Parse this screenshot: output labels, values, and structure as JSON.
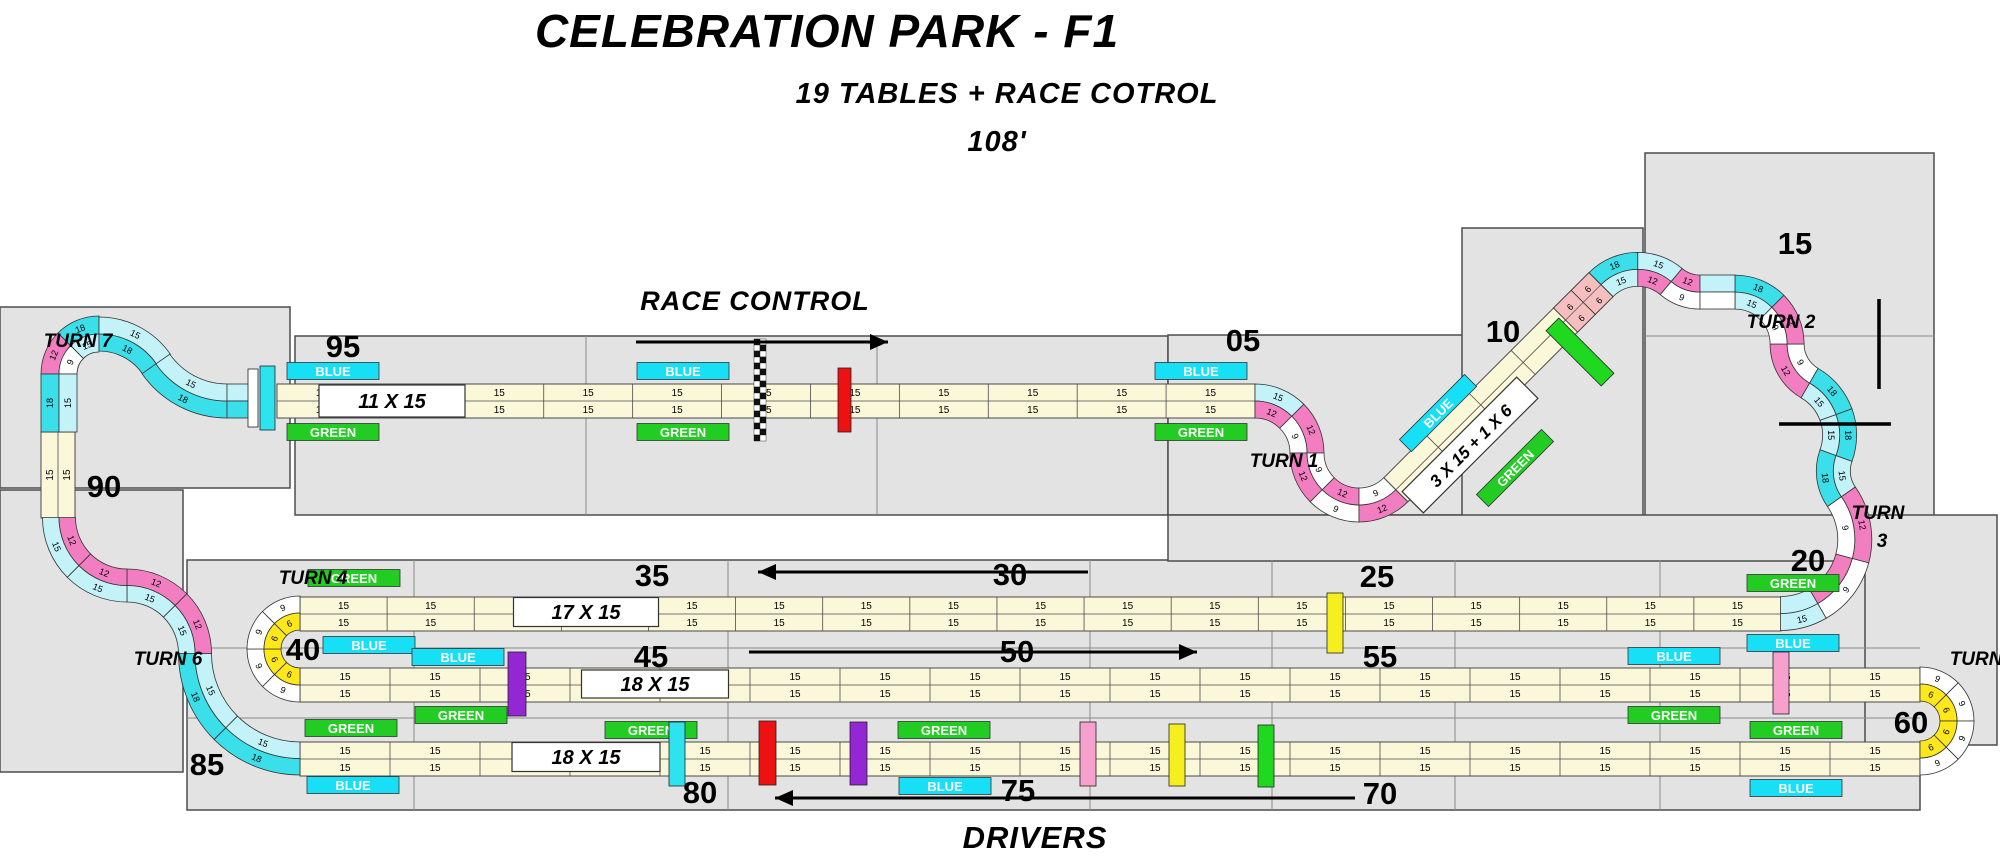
{
  "header": {
    "title": "CELEBRATION PARK - F1",
    "subtitle": "19 TABLES + RACE COTROL",
    "track_length": "108'",
    "race_control_label": "RACE CONTROL",
    "drivers_label": "DRIVERS"
  },
  "palette": {
    "table": "#E3E3E3",
    "table_stroke": "#4D4D4D",
    "straight": "#FBF8D9",
    "straight_stroke": "#4A4A4A",
    "C": "#3BDFE9",
    "P": "#C3F2F9",
    "K": "#F27EC1",
    "W": "#FFFFFF",
    "Y": "#FFE81A",
    "S": "#F5BFBF",
    "chip_blue": "#17DFF5",
    "chip_green": "#22CC22",
    "bar_red": "#EE1111",
    "bar_purple": "#9327D4",
    "bar_pink": "#F6A0CE",
    "bar_yellow": "#F6EF1F",
    "bar_green": "#20D820",
    "bar_cyan": "#2EE3EE",
    "bar_white": "#FFFFFF"
  },
  "turn_labels": [
    [
      "TURN 7",
      38,
      341
    ],
    [
      "TURN 2",
      1741,
      322
    ],
    [
      "TURN 1",
      1244,
      461
    ],
    [
      "TURN",
      1838,
      513
    ],
    [
      "3",
      1842,
      541
    ],
    [
      "TURN 4",
      273,
      578
    ],
    [
      "TURN 5",
      1944,
      659
    ],
    [
      "TURN 6",
      128,
      659
    ]
  ],
  "station_numbers": [
    [
      "95",
      343,
      347
    ],
    [
      "05",
      1243,
      341
    ],
    [
      "10",
      1503,
      332
    ],
    [
      "15",
      1795,
      244
    ],
    [
      "20",
      1808,
      561
    ],
    [
      "25",
      1377,
      577
    ],
    [
      "30",
      1010,
      575
    ],
    [
      "35",
      652,
      576
    ],
    [
      "40",
      303,
      650
    ],
    [
      "45",
      651,
      657
    ],
    [
      "50",
      1017,
      652
    ],
    [
      "55",
      1380,
      657
    ],
    [
      "60",
      1911,
      723
    ],
    [
      "70",
      1380,
      794
    ],
    [
      "75",
      1018,
      791
    ],
    [
      "80",
      700,
      793
    ],
    [
      "85",
      207,
      765
    ],
    [
      "90",
      104,
      487
    ]
  ],
  "tables": [
    [
      0,
      307,
      290,
      181
    ],
    [
      0,
      490,
      183,
      282
    ],
    [
      295,
      336,
      873,
      179
    ],
    [
      1168,
      335,
      327,
      180
    ],
    [
      1462,
      228,
      181,
      288
    ],
    [
      1645,
      153,
      289,
      363
    ],
    [
      187,
      560,
      1733,
      250
    ],
    [
      1168,
      515,
      697,
      46
    ],
    [
      1865,
      515,
      132,
      230
    ]
  ],
  "table_dividers": [
    [
      586,
      336,
      586,
      515
    ],
    [
      877,
      336,
      877,
      515
    ],
    [
      1645,
      336,
      1934,
      336
    ],
    [
      414,
      560,
      414,
      810
    ],
    [
      728,
      560,
      728,
      810
    ],
    [
      1090,
      560,
      1090,
      810
    ],
    [
      1272,
      560,
      1272,
      810
    ],
    [
      1455,
      560,
      1455,
      810
    ],
    [
      1660,
      560,
      1660,
      810
    ],
    [
      187,
      648,
      1920,
      648
    ],
    [
      187,
      718,
      1920,
      718
    ]
  ],
  "straights": [
    {
      "x": 277,
      "y": 384,
      "len": 978,
      "cells": 11,
      "dir": "h",
      "lbl": "15"
    },
    {
      "x": 300,
      "y": 597,
      "len": 1481,
      "cells": 17,
      "dir": "h",
      "lbl": "15"
    },
    {
      "x": 300,
      "y": 668,
      "len": 1620,
      "cells": 18,
      "dir": "h",
      "lbl": "15"
    },
    {
      "x": 300,
      "y": 742,
      "len": 1620,
      "cells": 18,
      "dir": "h",
      "lbl": "15"
    },
    {
      "x": 41,
      "y": 432,
      "len": 86,
      "cells": 1,
      "dir": "v",
      "lbl": "15"
    }
  ],
  "diagonal": {
    "cx": 1498.4,
    "cy": 387.2,
    "len": 290,
    "w": 34,
    "rot": -45,
    "dividers": [
      -85,
      -25,
      35,
      95
    ],
    "end_pieces": [
      [
        95,
        25,
        "6"
      ],
      [
        120,
        25,
        "6"
      ]
    ]
  },
  "sectors": [
    [
      300,
      649,
      19,
      36,
      53,
      90,
      135,
      "W",
      "9",
      "Y",
      "6"
    ],
    [
      300,
      649,
      19,
      36,
      53,
      135,
      180,
      "W",
      "9",
      "Y",
      "6"
    ],
    [
      300,
      649,
      19,
      36,
      53,
      180,
      225,
      "W",
      "9",
      "Y",
      "6"
    ],
    [
      300,
      649,
      19,
      36,
      53,
      225,
      270,
      "W",
      "9",
      "Y",
      "6"
    ],
    [
      1920,
      721,
      20,
      37,
      54,
      270,
      315,
      "W",
      "9",
      "Y",
      "6"
    ],
    [
      1920,
      721,
      20,
      37,
      54,
      315,
      360,
      "W",
      "9",
      "Y",
      "6"
    ],
    [
      1920,
      721,
      20,
      37,
      54,
      0,
      45,
      "W",
      "9",
      "Y",
      "6"
    ],
    [
      1920,
      721,
      20,
      37,
      54,
      45,
      90,
      "W",
      "9",
      "Y",
      "6"
    ],
    [
      300,
      653.5,
      88.5,
      105,
      121.5,
      90,
      135,
      "C",
      "18",
      "P",
      "15"
    ],
    [
      300,
      653.5,
      88.5,
      105,
      121.5,
      135,
      180,
      "C",
      "18",
      "P",
      "15"
    ],
    [
      127,
      653.5,
      51.5,
      68,
      84.5,
      0,
      -45,
      "K",
      "12",
      "P",
      "15"
    ],
    [
      127,
      653.5,
      51.5,
      68,
      84.5,
      -45,
      -90,
      "K",
      "12",
      "P",
      "15"
    ],
    [
      127,
      517.5,
      51.5,
      68,
      84.5,
      90,
      135,
      "P",
      "15",
      "K",
      "12"
    ],
    [
      127,
      517.5,
      51.5,
      68,
      84.5,
      135,
      180,
      "P",
      "15",
      "K",
      "12"
    ],
    [
      99,
      374,
      22,
      40,
      58,
      180,
      225,
      "K",
      "12",
      "W",
      "9"
    ],
    [
      99,
      374,
      22,
      40,
      58,
      225,
      270,
      "C",
      "18",
      "P",
      "15"
    ],
    [
      99,
      404,
      53,
      70,
      87,
      270,
      325,
      "P",
      "15",
      "C",
      "18"
    ],
    [
      227.1,
      314.1,
      69.9,
      86.9,
      103.9,
      145,
      90,
      "C",
      "18",
      "P",
      "15"
    ],
    [
      1255,
      453,
      35,
      52,
      69,
      270,
      315,
      "P",
      "15",
      "K",
      "12"
    ],
    [
      1255,
      453,
      35,
      52,
      69,
      315,
      360,
      "K",
      "12",
      "W",
      "9"
    ],
    [
      1359,
      453,
      35,
      52,
      69,
      180,
      135,
      "K",
      "12",
      "W",
      "9"
    ],
    [
      1359,
      453,
      35,
      52,
      69,
      135,
      90,
      "W",
      "9",
      "K",
      "12"
    ],
    [
      1359,
      453,
      35,
      52,
      69,
      90,
      45,
      "K",
      "12",
      "W",
      "9"
    ],
    [
      1637.8,
      321.4,
      35,
      52,
      69,
      225,
      270,
      "C",
      "18",
      "P",
      "15"
    ],
    [
      1637.8,
      321.4,
      35,
      52,
      69,
      270,
      310,
      "P",
      "15",
      "K",
      "12"
    ],
    [
      1700.1,
      247.1,
      28,
      45,
      62,
      130,
      90,
      "W",
      "9",
      "K",
      "12"
    ],
    [
      1735.1,
      344.1,
      35,
      52,
      69,
      270,
      315,
      "C",
      "18",
      "P",
      "15"
    ],
    [
      1735.1,
      344.1,
      35,
      52,
      69,
      315,
      360,
      "K",
      "12",
      "W",
      "9"
    ],
    [
      1832.1,
      344.1,
      28,
      45,
      62,
      180,
      120,
      "K",
      "12",
      "W",
      "9"
    ],
    [
      1779.6,
      435.1,
      43,
      60,
      77,
      300,
      340,
      "C",
      "18",
      "P",
      "15"
    ],
    [
      1779.6,
      435.1,
      43,
      60,
      77,
      340,
      380,
      "C",
      "18",
      "P",
      "15"
    ],
    [
      1878.3,
      471,
      28,
      45,
      62,
      200,
      145,
      "C",
      "18",
      "P",
      "15"
    ],
    [
      1780.6,
      539.3,
      57.2,
      74.2,
      91.2,
      325,
      375,
      "K",
      "12",
      "W",
      "9"
    ],
    [
      1780.6,
      539.3,
      57.2,
      74.2,
      91.2,
      375,
      420,
      "W",
      "9",
      "K",
      "12"
    ],
    [
      1780.6,
      539.3,
      57.2,
      74.2,
      91.2,
      420,
      450,
      "P",
      "15",
      "P",
      ""
    ]
  ],
  "track_rects": [
    [
      41,
      374,
      18,
      58,
      "C",
      "18",
      -90
    ],
    [
      59,
      374,
      18,
      58,
      "P",
      "15",
      -90
    ],
    [
      227,
      384,
      22,
      17,
      "P",
      "",
      0
    ],
    [
      227,
      401,
      22,
      17,
      "C",
      "",
      0
    ],
    [
      1700,
      275,
      35,
      17,
      "P",
      "",
      0
    ],
    [
      1700,
      292,
      35,
      17,
      "W",
      "",
      0
    ]
  ],
  "chips": [
    [
      "BLUE",
      333,
      371
    ],
    [
      "GREEN",
      333,
      432
    ],
    [
      "BLUE",
      683,
      371
    ],
    [
      "GREEN",
      683,
      432
    ],
    [
      "BLUE",
      1201,
      371
    ],
    [
      "GREEN",
      1201,
      432
    ],
    [
      "BLUE",
      1438,
      413,
      -45
    ],
    [
      "GREEN",
      1515,
      468,
      -45
    ],
    [
      "GREEN",
      354,
      578
    ],
    [
      "GREEN",
      1793,
      583
    ],
    [
      "BLUE",
      369,
      645
    ],
    [
      "BLUE",
      458,
      657
    ],
    [
      "GREEN",
      461,
      715
    ],
    [
      "BLUE",
      1674,
      656
    ],
    [
      "BLUE",
      1793,
      643
    ],
    [
      "GREEN",
      1674,
      715
    ],
    [
      "GREEN",
      1796,
      730
    ],
    [
      "GREEN",
      351,
      728
    ],
    [
      "GREEN",
      651,
      730
    ],
    [
      "GREEN",
      944,
      730
    ],
    [
      "BLUE",
      353,
      785
    ],
    [
      "BLUE",
      945,
      786
    ],
    [
      "BLUE",
      1796,
      788
    ]
  ],
  "bars": [
    [
      "bar_white",
      248,
      369,
      10,
      58,
      0
    ],
    [
      "bar_cyan",
      260,
      366,
      15,
      64,
      0
    ],
    [
      "bar_red",
      838,
      368,
      13,
      64,
      0
    ],
    [
      "bar_yellow",
      1327,
      593,
      16,
      60,
      0
    ],
    [
      "bar_purple",
      508,
      652,
      18,
      64,
      0
    ],
    [
      "bar_pink",
      1773,
      652,
      16,
      62,
      0
    ],
    [
      "bar_cyan",
      669,
      722,
      16,
      64,
      0
    ],
    [
      "bar_red",
      759,
      721,
      17,
      64,
      0
    ],
    [
      "bar_purple",
      850,
      722,
      17,
      63,
      0
    ],
    [
      "bar_pink",
      1080,
      722,
      16,
      64,
      0
    ],
    [
      "bar_yellow",
      1169,
      724,
      16,
      62,
      0
    ],
    [
      "bar_green",
      1258,
      725,
      16,
      62,
      0
    ],
    [
      "bar_green",
      1571,
      313,
      18,
      78,
      -45
    ]
  ],
  "boxes": [
    [
      "11 X 15",
      392,
      401,
      146,
      32,
      0
    ],
    [
      "17 X 15",
      586,
      612,
      145,
      29,
      0
    ],
    [
      "18 X 15",
      655,
      684,
      147,
      28,
      0
    ],
    [
      "18 X 15",
      586,
      757,
      148,
      29,
      0
    ],
    [
      "3 X 15 + 1 X 6",
      1470,
      445,
      162,
      30,
      -45
    ]
  ],
  "arrows": [
    [
      636,
      342,
      888,
      342,
      "right"
    ],
    [
      1088,
      572,
      758,
      572,
      "left"
    ],
    [
      749,
      652,
      1197,
      652,
      "right"
    ],
    [
      1355,
      798,
      775,
      798,
      "left"
    ]
  ],
  "black_lines": [
    [
      1779,
      424,
      1891,
      424
    ],
    [
      1879,
      299,
      1879,
      389
    ]
  ],
  "checkered": {
    "x": 754,
    "y": 339,
    "cols": 2,
    "rows": 17,
    "size": 6
  }
}
